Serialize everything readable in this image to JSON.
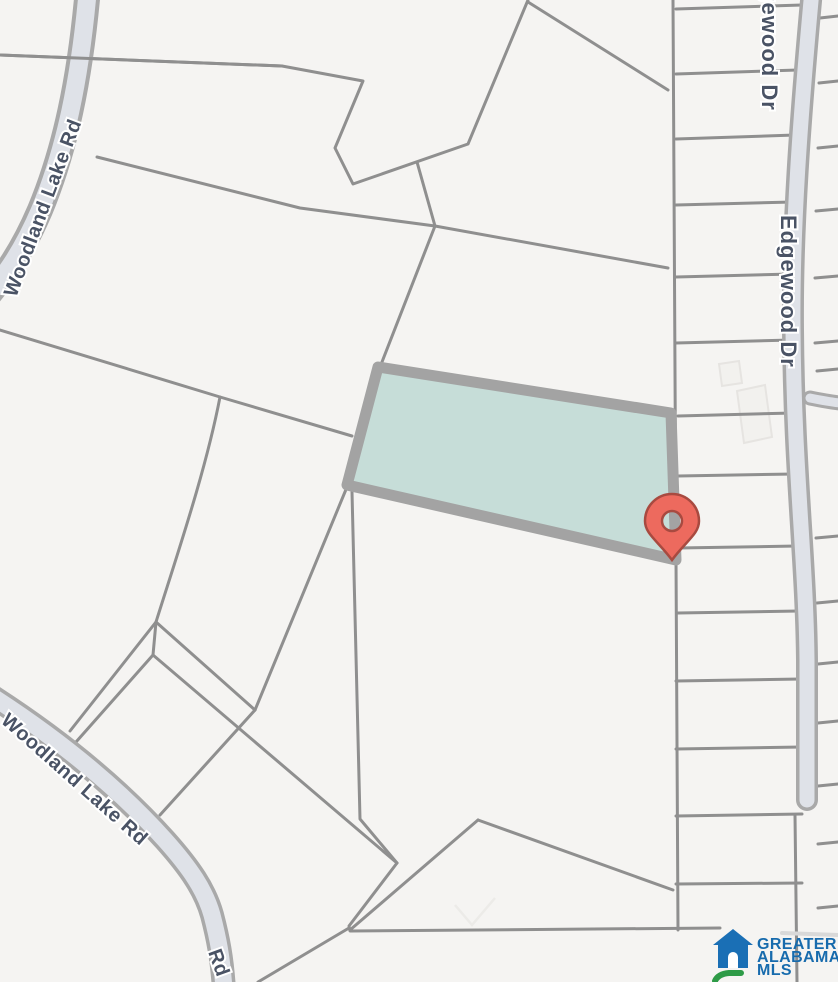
{
  "map": {
    "background_color": "#f5f4f2",
    "parcel_line_color": "#8f8f8f",
    "road_fill_color": "#dfe2e8",
    "road_casing_color": "#a9a9a9",
    "label_color": "#4a5365",
    "labels": {
      "woodland_top": "Woodland Lake Rd",
      "woodland_bottom": "Woodland Lake Rd",
      "woodland_rd_fragment": "Rd",
      "edgewood_top": "Edgewood Dr",
      "edgewood_main": "Edgewood Dr"
    },
    "highlighted_parcel": {
      "fill": "#c6ddd8",
      "border": "#a3a3a3",
      "selected": true
    },
    "marker": {
      "icon": "location-pin",
      "fill": "#ed6a5e",
      "stroke": "#a84a40"
    }
  },
  "logo": {
    "icon": "house-logo-icon",
    "line1": "GREATER",
    "line2": "ALABAMA",
    "line3": "MLS",
    "text_color": "#176bad",
    "house_color": "#1a6fb5",
    "hill_color": "#2e9b47"
  }
}
